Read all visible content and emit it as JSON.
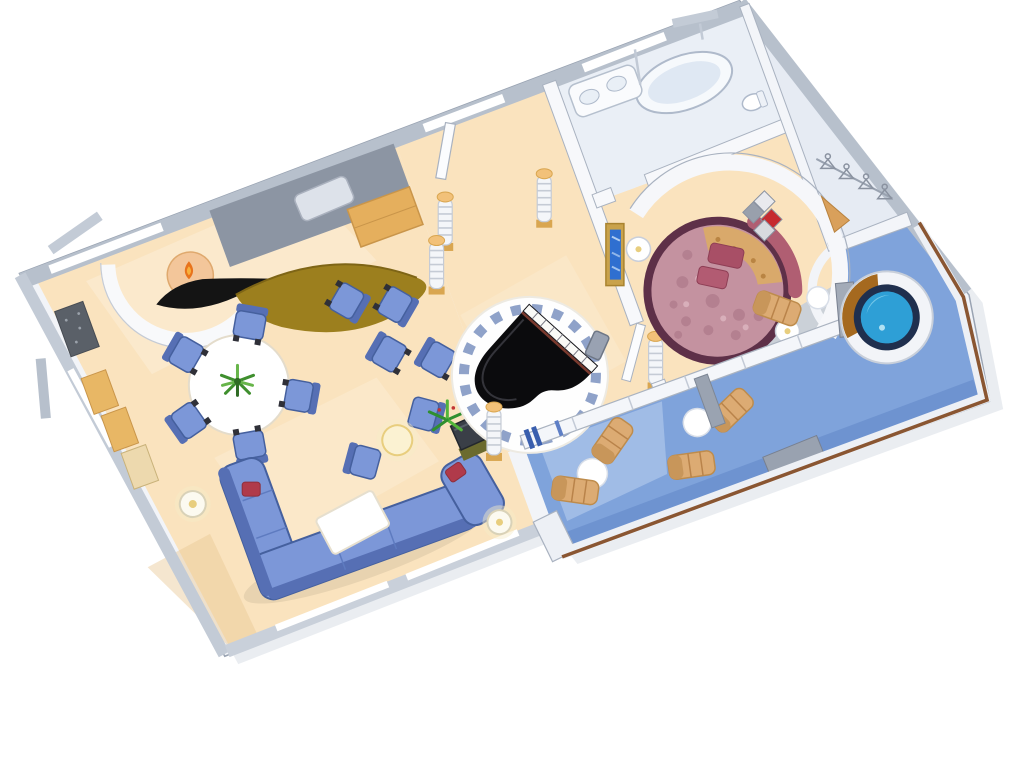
{
  "scene": {
    "subject": "cruise-ship-grand-suite-floor-plan",
    "style": "3d-isometric-cutaway-illustration",
    "background": "#FFFFFF"
  },
  "colors": {
    "shell": "#F2F4F8",
    "wall_gray": "#B7C0CC",
    "wall_edge": "#99A3B2",
    "floor_cream": "#FAE3BE",
    "floor_cream_light": "#FFF3DF",
    "bathroom_floor": "#EAEFF6",
    "closet_floor": "#E6EBF3",
    "deck_blue": "#7FA3DB",
    "deck_light": "#ABC4EA",
    "deck_shadow": "#5E84C5",
    "sofa_blue": "#7C97D8",
    "sofa_outline": "#45609E",
    "sofa_back": "#566FB4",
    "cushion_red": "#B03A4A",
    "media_wall": "#8C95A3",
    "bar_gold": "#9C7F1E",
    "wood_gold": "#E5AF5D",
    "piano_black": "#0B0B0D",
    "tile_ring": "#8FA2C9",
    "bed_rim": "#5E3048",
    "bed_mauve": "#C492A0",
    "bed_gold": "#D9A96B",
    "headboard_rose": "#B05E72",
    "pillow_rose": "#A84F66",
    "art_red": "#C62A2E",
    "tv_frame_gold": "#C9A24B",
    "tv_screen_blue": "#2F6FD0",
    "lounger_tan": "#DCAB73",
    "table_white": "#FFFFFF",
    "rail_brown": "#8A5632",
    "glass_bar_blue": "#3A5FAE",
    "hottub_ring": "#1F2F4E",
    "hottub_water": "#2E9FD6",
    "hottub_water_light": "#74C7E8",
    "hottub_wood": "#A5691F",
    "plant_green": "#3F8F2E",
    "plant_light": "#67B54A",
    "column_cap": "#F2C179",
    "column_base": "#D9A650",
    "fireplace_peach": "#F3C69A",
    "flame_orange": "#E8731C"
  },
  "rooms": [
    {
      "name": "living-room",
      "furniture": [
        "sectional-sofa",
        "red-cushions",
        "coffee-table",
        "dining-table",
        "dining-chairs",
        "club-chairs",
        "lounge-chair-pair",
        "glowing-side-table",
        "curved-bar-counter",
        "fireplace",
        "media-wall",
        "tv-cabinet",
        "palm-centerpiece",
        "floor-lamps",
        "wall-cabinets",
        "entry-mat"
      ]
    },
    {
      "name": "piano-lounge",
      "furniture": [
        "grand-piano",
        "piano-bench",
        "circular-tile-platform",
        "striped-columns",
        "entry-door"
      ]
    },
    {
      "name": "bedroom",
      "furniture": [
        "round-bed",
        "bed-pillows",
        "curved-headboard",
        "nightstands",
        "wall-tv",
        "diamond-wall-art",
        "curved-wall"
      ]
    },
    {
      "name": "bathroom",
      "furniture": [
        "bathtub",
        "vanity-double-sink",
        "toilet",
        "glass-partition"
      ]
    },
    {
      "name": "walk-in-closet",
      "furniture": [
        "hanger-rail",
        "clothes-hangers",
        "gold-shelf"
      ]
    },
    {
      "name": "private-balcony",
      "furniture": [
        "whirlpool-hot-tub",
        "lounge-chairs",
        "round-tables",
        "railing-with-wood-handrail",
        "privacy-dividers",
        "sliding-glass-wall"
      ]
    }
  ],
  "counts": {
    "dining_chairs": 5,
    "club_chairs": 4,
    "lounge_chair_pair": 2,
    "balcony_loungers": 5,
    "balcony_tables": 3,
    "striped_columns": 5,
    "clothes_hangers": 4,
    "floor_lamps": 2,
    "red_cushions": 2,
    "nightstands": 2
  }
}
